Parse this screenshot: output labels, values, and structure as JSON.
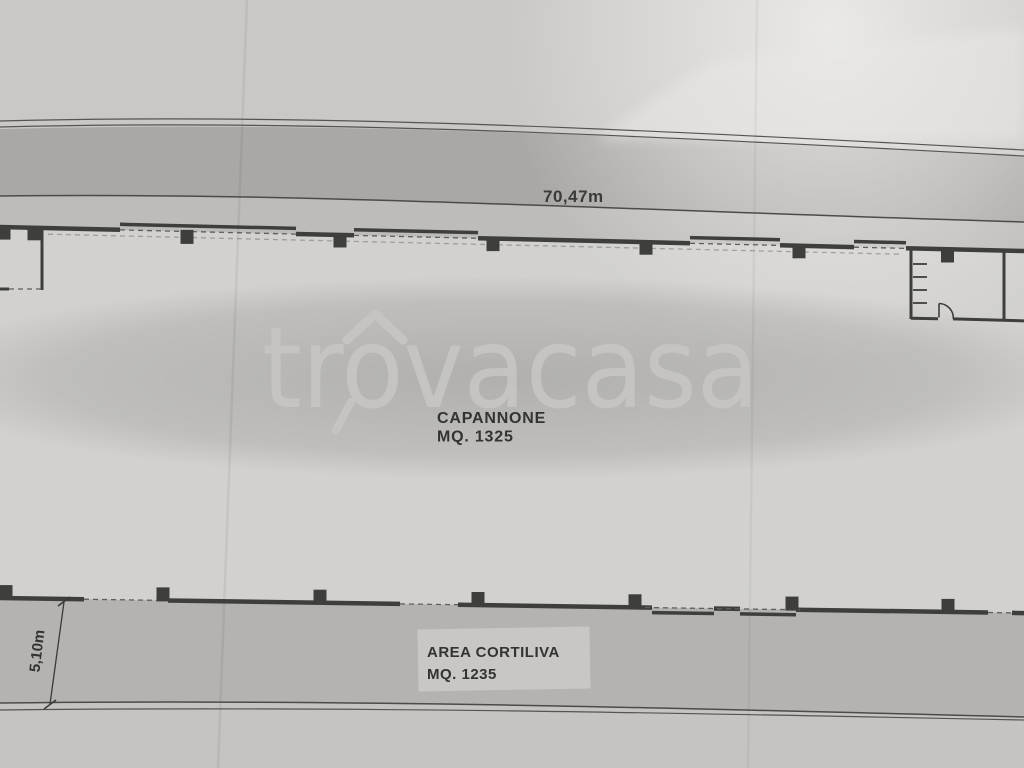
{
  "watermark": {
    "text": "trovacasa"
  },
  "plan": {
    "street_dimension": "70,47m",
    "side_dimension": "5,10m",
    "building": {
      "name": "CAPANNONE",
      "area": "MQ. 1325"
    },
    "courtyard": {
      "name": "AREA CORTILIVA",
      "area": "MQ. 1235"
    }
  },
  "colors": {
    "paper": "#c9c8c6",
    "road": "#a9a8a6",
    "interior": "#d2d1cf",
    "courtyard": "#b4b3b1",
    "ink": "#3e3e3c",
    "watermark": "#c6c5c3",
    "label_text": "#333331"
  }
}
